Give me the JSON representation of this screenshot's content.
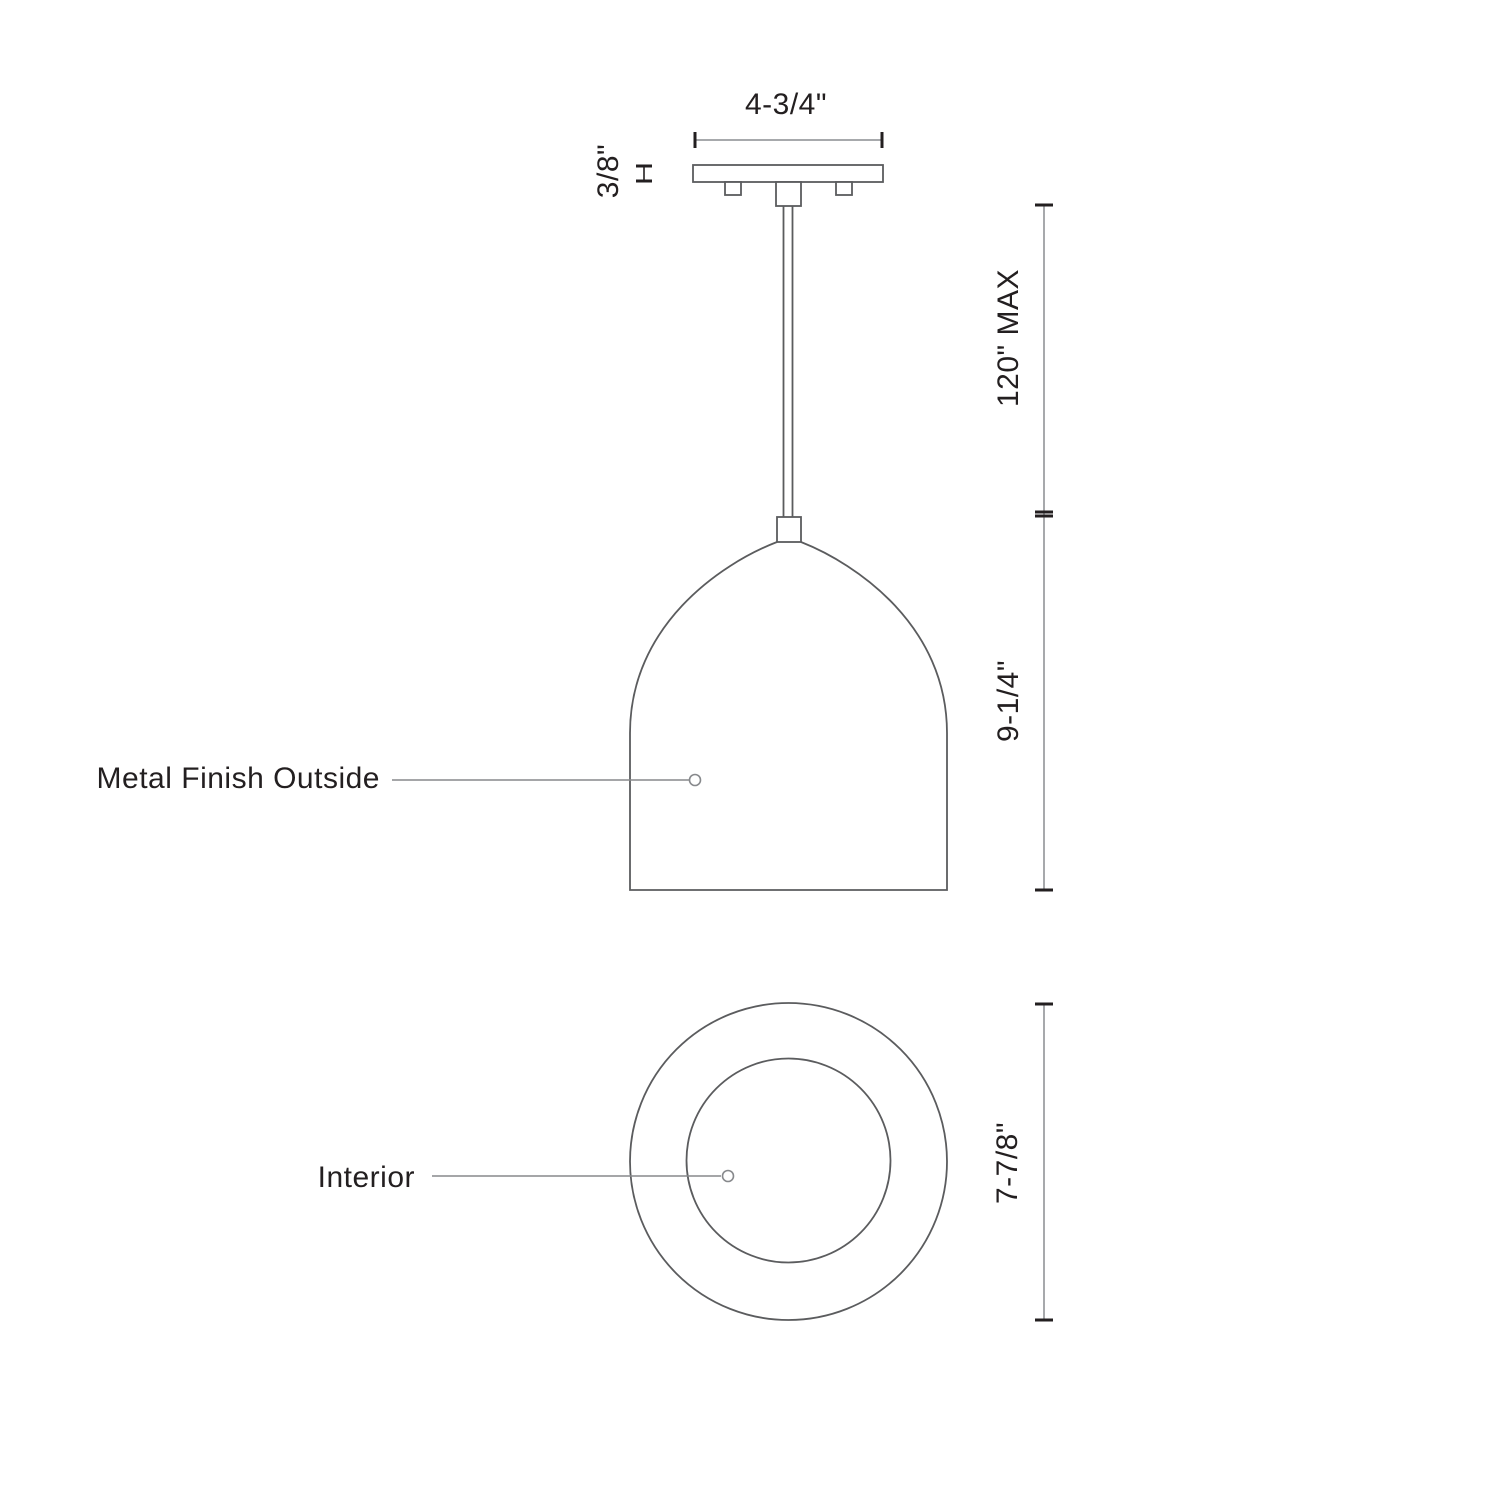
{
  "drawing": {
    "type": "pendant-light-dimension-spec",
    "front_view": {
      "canopy_width_label": "4-3/4\"",
      "canopy_thickness_label": "3/8\"",
      "rod_length_label": "120\" MAX",
      "shade_height_label": "9-1/4\"",
      "shade_callout_label": "Metal Finish Outside"
    },
    "bottom_view": {
      "diameter_label": "7-7/8\"",
      "interior_callout_label": "Interior"
    },
    "colors": {
      "object_outline": "#5b5c5e",
      "dimension_line": "#a7a9ac",
      "tick_and_text": "#231f20",
      "background": "#ffffff"
    }
  }
}
